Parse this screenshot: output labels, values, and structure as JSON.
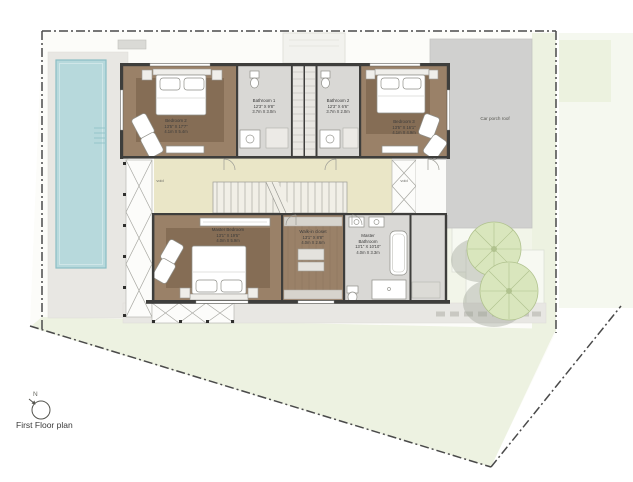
{
  "footer": {
    "title": "First Floor plan",
    "compass_label": "N"
  },
  "site": {
    "car_porch_label": "Car porch roof",
    "void_label_left": "void",
    "void_label_right": "void"
  },
  "rooms": {
    "bedroom2": {
      "name": "Bedroom 2",
      "imperial": "13'5\" X 17'7\"",
      "metric": "4.1m X 5.4m"
    },
    "bathroom1": {
      "name": "Bathroom 1",
      "imperial": "12'3\" X 9'8\"",
      "metric": "3.7m X 3.0m"
    },
    "bathroom2": {
      "name": "Bathroom 2",
      "imperial": "12'3\" X 6'6\"",
      "metric": "3.7m X 2.0m"
    },
    "bedroom3": {
      "name": "Bedroom 3",
      "imperial": "13'5\" X 16'1\"",
      "metric": "4.1m X 4.9m"
    },
    "master_bedroom": {
      "name": "Master Bedroom",
      "imperial": "13'1\" X 19'5\"",
      "metric": "4.0m X 5.9m"
    },
    "walk_in_closet": {
      "name": "Walk-in closet",
      "imperial": "13'1\" X 8'8\"",
      "metric": "4.0m X 2.6m"
    },
    "master_bathroom": {
      "name_line1": "Master",
      "name_line2": "Bathroom",
      "imperial": "13'1\" X 10'10\"",
      "metric": "4.0m X 3.3m"
    }
  },
  "colors": {
    "wall": "#3e3e3c",
    "wood_floor": "#9a8168",
    "wood_rug": "#856d55",
    "bath_floor": "#d9d8d5",
    "hall_floor": "#eae6c7",
    "pool_water": "#b7d9dc",
    "pool_edge": "#8abec4",
    "deck": "#e8e7e3",
    "lawn": "#edf2e1",
    "lawn_pale": "#f5f8ef",
    "roof": "#d0d0cf",
    "tree": "#d9e6bd",
    "tree_line": "#b0c28e",
    "shadow": "#9aa093",
    "boundary": "#4a4a4a",
    "text": "#3a3a3a"
  }
}
